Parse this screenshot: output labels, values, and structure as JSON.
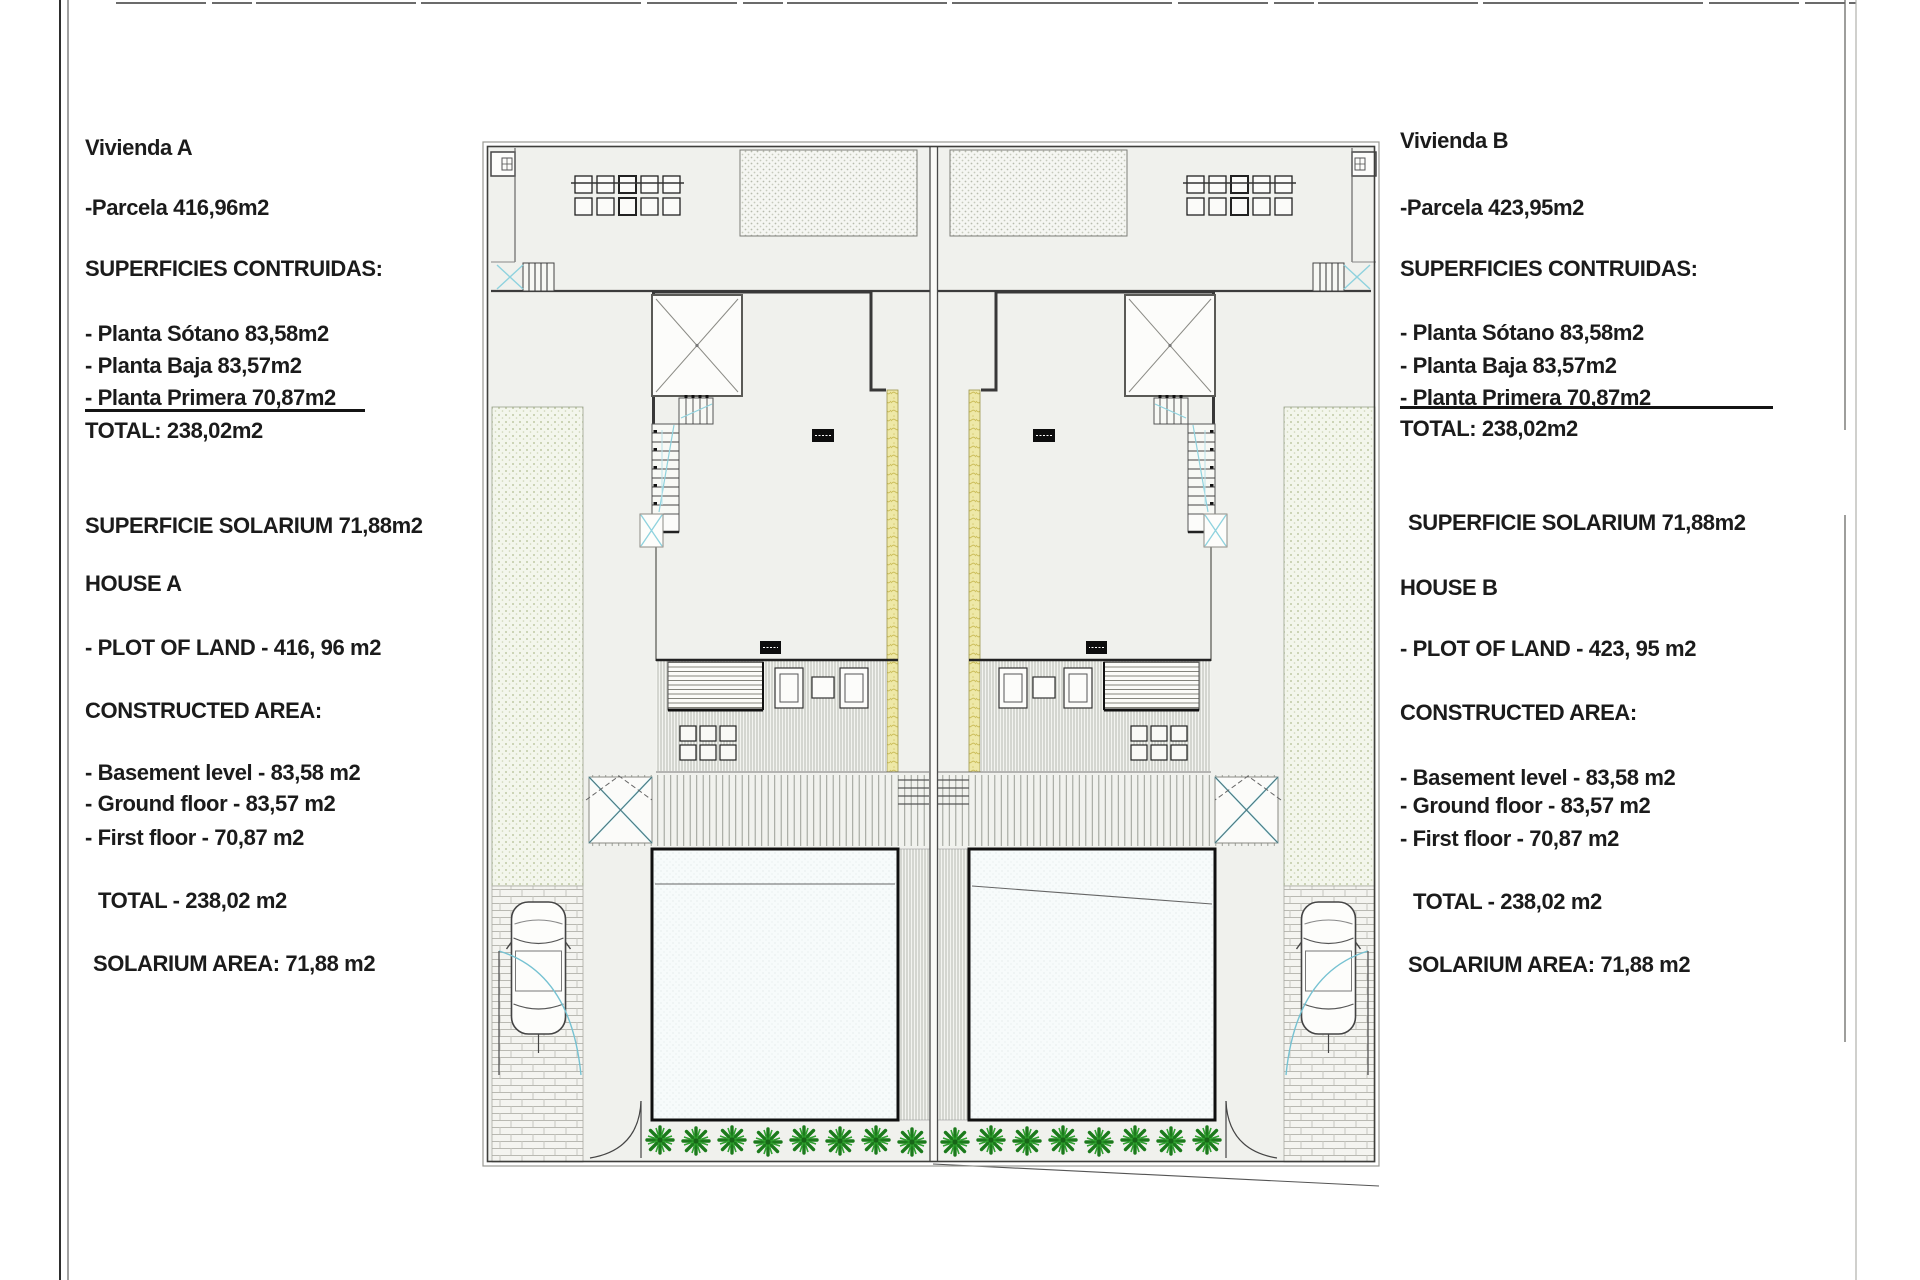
{
  "panel_a": {
    "lines": [
      "Vivienda A",
      "-Parcela 416,96m2",
      "SUPERFICIES CONTRUIDAS:",
      "- Planta Sótano 83,58m2",
      "- Planta Baja 83,57m2",
      "- Planta Primera 70,87m2",
      "TOTAL: 238,02m2",
      "SUPERFICIE SOLARIUM 71,88m2",
      "HOUSE A",
      "- PLOT OF LAND - 416, 96 m2",
      "CONSTRUCTED AREA:",
      "- Basement level - 83,58 m2",
      "- Ground floor - 83,57 m2",
      "- First floor - 70,87 m2",
      "TOTAL - 238,02 m2",
      "SOLARIUM AREA: 71,88 m2"
    ]
  },
  "panel_b": {
    "lines": [
      "Vivienda B",
      "-Parcela 423,95m2",
      "SUPERFICIES CONTRUIDAS:",
      "- Planta Sótano 83,58m2",
      "- Planta Baja 83,57m2",
      "- Planta Primera 70,87m2",
      "TOTAL: 238,02m2",
      "SUPERFICIE SOLARIUM 71,88m2",
      "HOUSE B",
      "- PLOT OF LAND - 423, 95 m2",
      "CONSTRUCTED AREA:",
      "- Basement level - 83,58 m2",
      "- Ground floor - 83,57 m2",
      "- First floor - 70,87 m2",
      "TOTAL - 238,02 m2",
      "SOLARIUM AREA: 71,88 m2"
    ]
  },
  "plan": {
    "colors": {
      "wall_dark": "#3a3a3a",
      "deck_strip_yellow": "#eee8a7",
      "garden_green_tint": "#f3f6ec",
      "bush_green": "#1c7a1c",
      "glass_cyan": "#6cc6d6",
      "pool_fill": "#f7fbfb",
      "plan_background": "#f0f1ed"
    }
  }
}
